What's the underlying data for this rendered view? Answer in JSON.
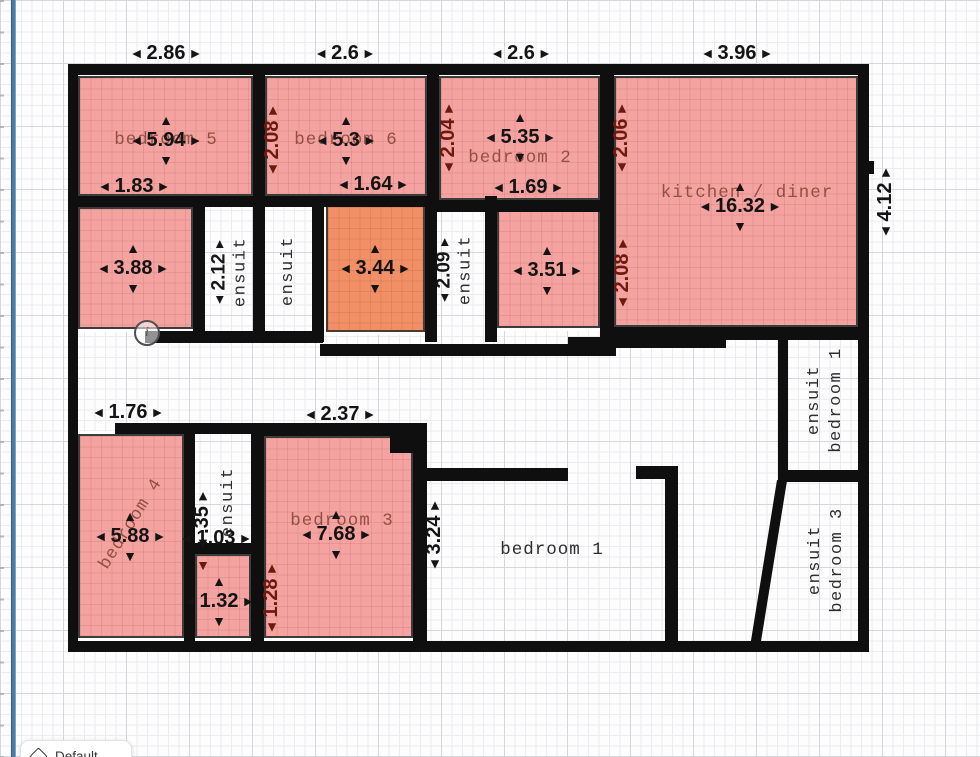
{
  "chip": {
    "label": "Default"
  },
  "icons": {
    "arrow_left": "◄",
    "arrow_right": "►",
    "arrow_up": "▲",
    "arrow_down": "▼",
    "info_glyph": "i"
  },
  "rooms": {
    "bedroom5": "bedroom 5",
    "bedroom6": "bedroom 6",
    "bedroom2": "bedroom 2",
    "kitchen": "kitchen / diner",
    "bedroom4": "bedroom 4",
    "bedroom3": "bedroom 3",
    "bedroom1": "bedroom 1",
    "ensuit": "ensuit",
    "ensuit_b1_l1": "ensuit",
    "ensuit_b1_l2": "bedroom 1",
    "ensuit_b3_l1": "ensuit",
    "ensuit_b3_l2": "bedroom 3"
  },
  "dims": {
    "bedroom5_top": "2.86",
    "bedroom6_top": "2.6",
    "bedroom2_top": "2.6",
    "kitchen_top": "3.96",
    "bedroom5_area": "5.94",
    "bedroom6_area": "5.3",
    "bedroom2_area": "5.35",
    "kitchen_area": "16.32",
    "bedroom5_inner": "1.83",
    "bedroom6_inner": "1.64",
    "bedroom2_inner": "1.69",
    "bedroom6_left": "2.08",
    "bedroom2_left": "2.04",
    "kitchen_left_upper": "2.06",
    "kitchen_left_lower": "2.08",
    "kitchen_right": "4.12",
    "room_a_area": "3.88",
    "room_b_area": "3.44",
    "room_c_area": "3.51",
    "ensuit_top_width": "2.12",
    "ensuit_mid_width": "2.09",
    "hall_width": "1.76",
    "bedroom3_top": "2.37",
    "bedroom4_area": "5.88",
    "bedroom3_area": "7.68",
    "small_room_area": "1.32",
    "ensuit_bottom_width": ".35",
    "ensuit_bottom_length": "1.03",
    "bedroom3_left": "1.28",
    "bedroom1_left": "3.24"
  }
}
